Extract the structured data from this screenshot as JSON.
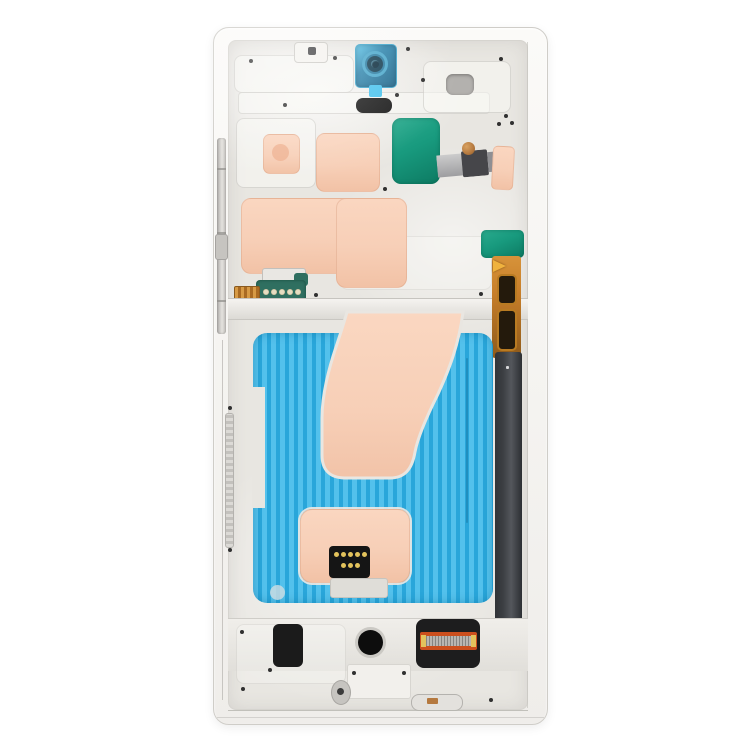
{
  "scene": {
    "type": "product-photo",
    "description": "Rear view of a smartphone front-housing mid-frame replacement part (LCD frame chassis) lying on a plain white background",
    "background_color": "#ffffff",
    "visible_text": ""
  },
  "palette": {
    "background": "#ffffff",
    "frame_outer": "#f6f5f2",
    "frame_border": "#cfcdc8",
    "inner_metal": "#e8e6e1",
    "emboss_light": "#f4f2ee",
    "camera_film_blue": "#2e85ad",
    "camera_film_edge": "#5cc6ea",
    "camera_ring_dark": "#123c50",
    "pull_tab_blue": "#49c3ee",
    "black_part": "#1b1b1b",
    "speaker_gray": "#b3b1ae",
    "adhesive_peach": "#f7cfb7",
    "adhesive_peach_deep": "#f0b697",
    "teal_pad": "#189a7e",
    "ribbon_gray": "#a9a9ac",
    "ribbon_dark": "#46464a",
    "copper": "#b5793f",
    "gold_contact": "#e3c35c",
    "green_pcb": "#2f6f60",
    "orange_flex": "#c87f2a",
    "flex_window_dark": "#241a0c",
    "side_strip_dark": "#3c3f43",
    "blue_film_light": "#53c1ec",
    "blue_film_dark": "#29a6da",
    "connector_orange": "#cc4f1d",
    "connector_silver": "#b9b6b1"
  },
  "parts": [
    {
      "id": "metal-frame",
      "label": "silver mid-frame chassis"
    },
    {
      "id": "front-camera-film",
      "label": "blue protective film over front camera hole with pull tab"
    },
    {
      "id": "earpiece-recess",
      "label": "gray earpiece speaker recess"
    },
    {
      "id": "mic-pill",
      "label": "black rounded sensor opening"
    },
    {
      "id": "adhesive-pads",
      "label": "peach/pink adhesive pads"
    },
    {
      "id": "teal-flex-pads",
      "label": "teal-green flex cable pads"
    },
    {
      "id": "contact-pcb",
      "label": "green PCB strip with five gold contact dots"
    },
    {
      "id": "side-key-flex",
      "label": "orange side-key flex cable with dark windows and gold arrow sticker"
    },
    {
      "id": "side-dark-strip",
      "label": "dark antenna strip along right edge"
    },
    {
      "id": "blue-ribbed-adhesive",
      "label": "cyan ribbed display adhesive sheet"
    },
    {
      "id": "main-adhesive-strip",
      "label": "large curved peach adhesive strip"
    },
    {
      "id": "coil-connector",
      "label": "black coil connector with gold contact dots"
    },
    {
      "id": "board-connector",
      "label": "orange board-to-board connector in black housing"
    },
    {
      "id": "button-rail",
      "label": "metal side-button contact rail on left edge"
    }
  ]
}
